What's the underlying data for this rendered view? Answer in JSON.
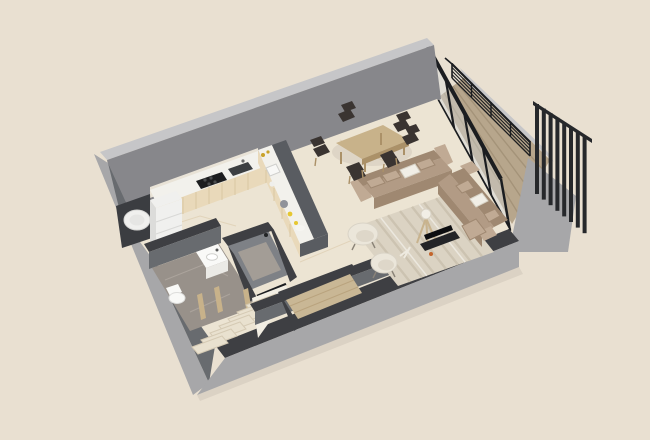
{
  "scene": {
    "type": "3d-floorplan-render",
    "description": "Isometric 3D cutaway render of a small one-bedroom apartment floor plan on a plain beige backdrop; no text or UI controls are visible.",
    "rooms": [
      {
        "name": "kitchen",
        "features": [
          "wall-counter-with-cooktop-and-sink",
          "peninsula-island-with-bar-ledge",
          "refrigerator",
          "washing-machine"
        ]
      },
      {
        "name": "bathroom",
        "features": [
          "vanity-sink",
          "toilet",
          "gray-marble-floor"
        ]
      },
      {
        "name": "shower-room",
        "features": [
          "walk-in-shower-cabin",
          "glass-door"
        ]
      },
      {
        "name": "hallway",
        "features": [
          "staircase-down",
          "wood-door-frames"
        ]
      },
      {
        "name": "entry-closet",
        "features": [
          "wood-floor"
        ]
      },
      {
        "name": "living-room",
        "features": [
          "two-taupe-sofas",
          "white-accent-pillows",
          "striped-rug",
          "two-cream-armchairs",
          "tripod-floor-lamp",
          "tv-console"
        ]
      },
      {
        "name": "dining-area",
        "features": [
          "oak-dining-table",
          "six-dark-chairs"
        ]
      },
      {
        "name": "balcony",
        "features": [
          "wood-deck",
          "black-cable-railing",
          "black-slat-privacy-screen",
          "floor-to-ceiling-glazing"
        ]
      }
    ],
    "walls": {
      "back-wall": "tall solid gray, uncut",
      "front-walls": "cut low to reveal interior",
      "right-side": "black-framed floor-to-ceiling glass to balcony"
    }
  },
  "colors": {
    "bg": "#e9e0d1",
    "wall_top": "#c6c6c8",
    "wall_inner": "#87878b",
    "wall_outer": "#a7a7a9",
    "wall_mid": "#686b6f",
    "wall_dark": "#3e3f43",
    "floor": "#ece4d3",
    "floor_vein": "#d9c6a6",
    "backsplash": "#e9e3d7",
    "counter_white": "#f2f1ec",
    "cabinet_cream": "#e9d9ba",
    "cabinet_line": "#d6c29c",
    "island_dark": "#595c61",
    "cooktop_black": "#1c1d1f",
    "sink_dark": "#3c3f42",
    "appliance_white": "#f0f0ee",
    "appliance_shade": "#dcdcda",
    "niche_dark": "#3b3d41",
    "fixture_white": "#f9f9f7",
    "fixture_shade": "#ebeae6",
    "marble_gray": "#98918a",
    "marble_light": "#b4aca4",
    "shower_inner": "#7e8186",
    "shower_floor": "#a39d96",
    "wood": "#c8b28a",
    "wood_dark": "#ab9168",
    "entry_wood": "#c9b795",
    "chair_dark": "#3a3431",
    "sofa": "#b29b85",
    "sofa_dark": "#9f8871",
    "sofa_light": "#c0aa94",
    "pillow_white": "#f1eee6",
    "rug": "#dbd3c3",
    "rug_stripe": "#c8beab",
    "rug_white": "#efece4",
    "armchair": "#ebe6da",
    "armchair_inner": "#ded7c9",
    "lamp_wood": "#c8b38e",
    "tv_black": "#232427",
    "tv_screen": "#0d0e10",
    "accent_orange": "#c3652c",
    "glass": "rgba(210,218,220,0.40)",
    "frame_black": "#1b1d20",
    "deck_wood": "#b7a68c",
    "deck_line": "#9b8a6f",
    "screen_black": "#26282b",
    "stair": "#e9e1cf",
    "stair_edge": "#d5cab4",
    "stair_side": "#f2eee3",
    "gold": "#c9a22b",
    "yellow": "#e6c731",
    "shadow": "rgba(40,35,25,0.07)"
  }
}
